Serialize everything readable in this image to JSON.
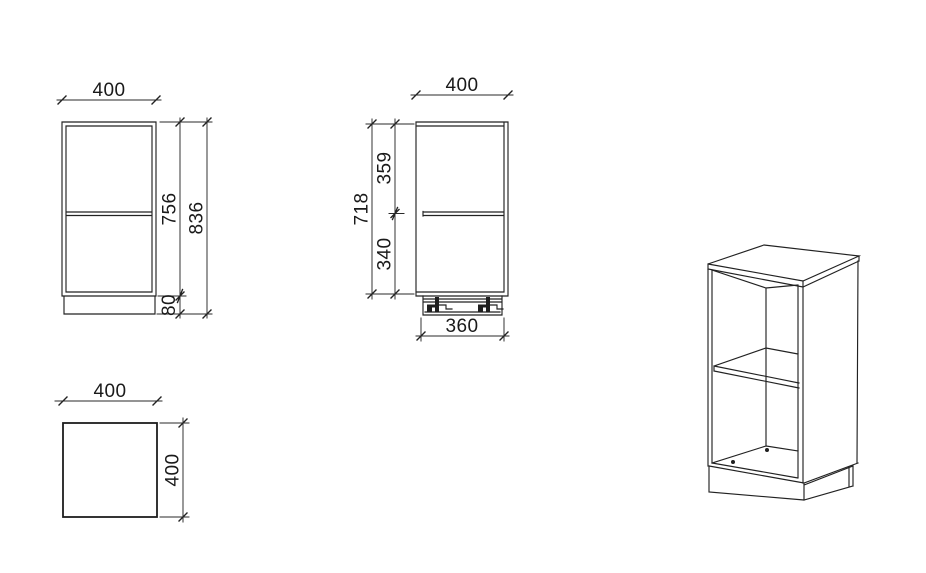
{
  "views": {
    "front": {
      "width": "400",
      "body_height": "756",
      "total_height": "836",
      "plinth_height": "80"
    },
    "side": {
      "depth": "400",
      "above_shelf": "359",
      "inner_height": "718",
      "below_shelf": "340",
      "plinth_depth": "360"
    },
    "plan": {
      "width": "400",
      "depth": "400"
    }
  },
  "colors": {
    "line": "#222222",
    "text": "#1a1a1a",
    "background": "#ffffff"
  }
}
